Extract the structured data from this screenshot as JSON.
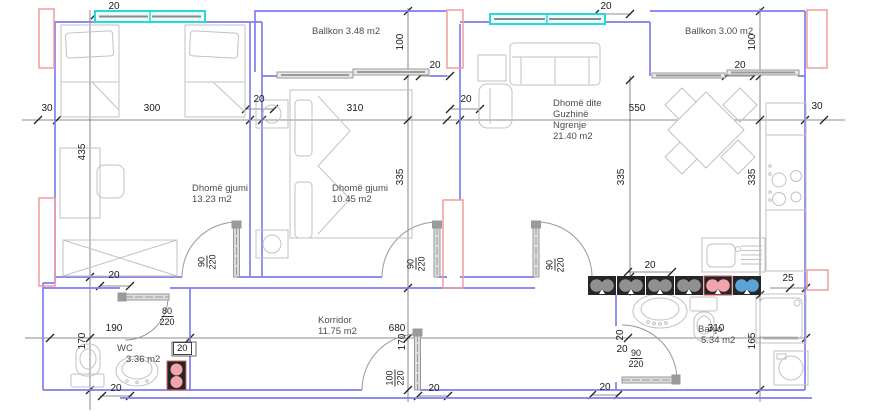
{
  "rooms": {
    "ballkon1": {
      "label": "Ballkon 3.48 m2"
    },
    "ballkon2": {
      "label": "Ballkon 3.00 m2"
    },
    "bedroom1": {
      "name": "Dhomë gjumi",
      "area": "13.23 m2"
    },
    "bedroom2": {
      "name": "Dhomë gjumi",
      "area": "10.45 m2"
    },
    "living": {
      "name": "Dhomë dite",
      "name2": "Guzhinë",
      "name3": "Ngrenje",
      "area": "21.40 m2"
    },
    "korridor": {
      "name": "Korridor",
      "area": "11.75 m2"
    },
    "wc": {
      "name": "WC",
      "area": "3.36 m2"
    },
    "banjo": {
      "name": "Banjo",
      "area": "5.34 m2"
    }
  },
  "dims": {
    "win_left": "20",
    "win_right": "20",
    "row_left_30": "30",
    "row_300": "300",
    "row_wall_20_a": "20",
    "row_310": "310",
    "row_wall_20_b": "20",
    "row_550": "550",
    "row_right_30": "30",
    "balc1_depth": "100",
    "balc1_door_20": "20",
    "balc2_depth": "100",
    "balc2_door_20": "20",
    "col_435": "435",
    "col_bed2_335": "335",
    "col_living_335": "335",
    "col_right_335": "335",
    "bed1_wall_20": "20",
    "wc_190": "190",
    "wc_170": "170",
    "wc_box_20": "20",
    "wc_bottom_20": "20",
    "cor_680": "680",
    "cor_170": "170",
    "entry_20": "20",
    "shaft_20": "20",
    "kitchen_25": "25",
    "banjo_310": "310",
    "banjo_165": "165",
    "banjo_rot_20": "20",
    "banjo_20": "20",
    "banjo_left_20": "20"
  },
  "doors": {
    "bed1": {
      "w": "90",
      "h": "220"
    },
    "bed2": {
      "w": "90",
      "h": "220"
    },
    "living": {
      "w": "90",
      "h": "220"
    },
    "wc": {
      "w": "80",
      "h": "220"
    },
    "banjo": {
      "w": "90",
      "h": "220"
    },
    "entry": {
      "w": "100",
      "h": "220"
    }
  },
  "colors": {
    "wall_blue": "#7f7ff0",
    "structure_red": "#f49c9c",
    "window_cyan": "#29d8d8",
    "furniture_gray": "#c2c2c2",
    "shaft_black": "#262626",
    "shaft_gray": "#909090",
    "shaft_pink": "#f2a3ab",
    "shaft_blue": "#5ba4d8"
  }
}
